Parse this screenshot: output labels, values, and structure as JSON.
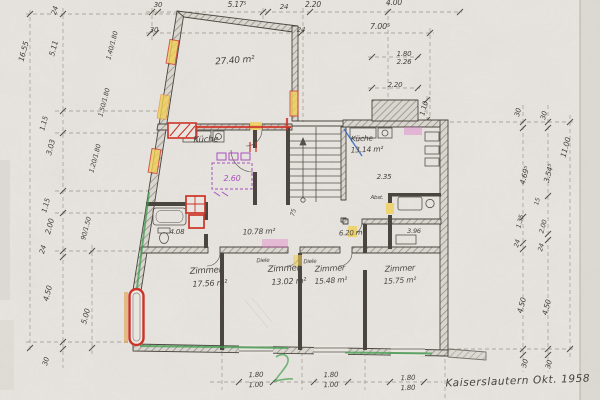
{
  "drawing": {
    "title": "Kaiserslautern Okt. 1958",
    "rooms": {
      "top_room_area": "27.40 m²",
      "kueche_left": "Küche",
      "kueche_left_sketch_dim": "2.60",
      "bad_dim": "4.08",
      "diele_area": "10.78 m²",
      "kueche_right": "Küche",
      "kueche_right_area": "13.14 m²",
      "kueche_right_dim": "2.35",
      "abstell": "Abst.",
      "corridor_area": "6.20 m²",
      "wc_dim": "3.96",
      "stair_dim": "75",
      "zimmer1": "Zimmer",
      "zimmer1_area": "17.56 m²",
      "zimmer2": "Zimmer",
      "zimmer2_area": "13.02 m²",
      "zimmer3": "Zimmer",
      "zimmer3_area": "15.48 m²",
      "zimmer4": "Zimmer",
      "zimmer4_area": "15.75 m²",
      "door_note1": "Diele",
      "door_note2": "Diele"
    },
    "dimensions": {
      "left": [
        "24",
        "16.55",
        "5.11",
        "1.15",
        "3.03",
        "1.15",
        "2.00",
        "24",
        "4.50",
        "30",
        "5.00"
      ],
      "left_windows": [
        "1.40/1.80",
        "1.50/1.80",
        "1.20/1.80",
        "90/1.50"
      ],
      "top_row1": [
        "30",
        "5.17⁵",
        "24",
        "2.20",
        "4.00"
      ],
      "top_row2": [
        "30",
        "24",
        "7.00⁵"
      ],
      "top_right": [
        "1.80",
        "2.26",
        "2.20",
        "1.10"
      ],
      "right_col1": [
        "30",
        "4.69⁵",
        "15",
        "1.35",
        "24",
        "4.50",
        "30"
      ],
      "right_col2": [
        "30",
        "3.54⁵",
        "2.00",
        "24",
        "4.50",
        "30"
      ],
      "right_overall": "11.00",
      "bottom": [
        [
          "1.80",
          "1.00"
        ],
        [
          "1.80",
          "1.00"
        ],
        [
          "1.80",
          "1.80"
        ]
      ]
    },
    "colors": {
      "paper": "#e9e6e1",
      "pencil": "#45413c",
      "red": "#cc3327",
      "yellow": "#f0cf57",
      "green": "#3f9e4d",
      "purple": "#a84fbe",
      "blue": "#3068c8",
      "pink": "#e07ec9",
      "orange": "#e2973b"
    }
  }
}
